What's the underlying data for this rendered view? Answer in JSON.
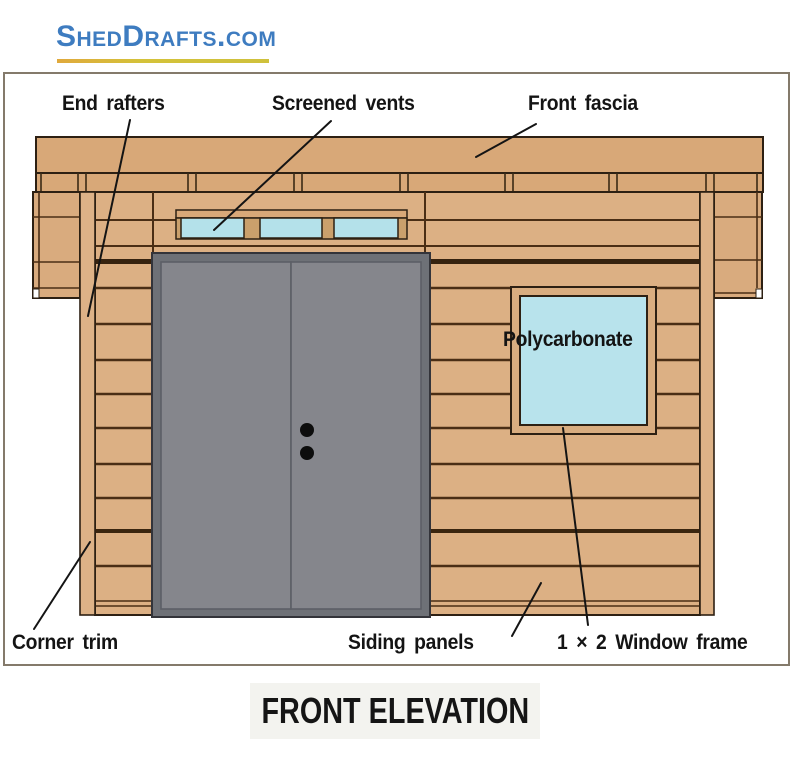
{
  "logo": {
    "text": "ShedDrafts.com",
    "color": "#3e7cc0",
    "underline_color": "#d0c23b"
  },
  "diagram": {
    "title": "FRONT ELEVATION",
    "callouts": {
      "end_rafters": "End rafters",
      "screened_vents": "Screened vents",
      "front_fascia": "Front fascia",
      "polycarbonate": "Polycarbonate",
      "corner_trim": "Corner trim",
      "siding_panels": "Siding panels",
      "window_frame": "1 × 2 Window frame"
    },
    "parts": [
      "End rafters",
      "Screened vents",
      "Front fascia",
      "Polycarbonate",
      "Corner trim",
      "Siding panels",
      "1 × 2 Window frame"
    ],
    "colors": {
      "wood_siding": "#dcb084",
      "wood_fascia": "#d8a878",
      "wood_trim": "#ddb287",
      "board_gap_line": "#4a2e15",
      "outline": "#2d2013",
      "door_leaf_gray": "#85868c",
      "door_frame_gray": "#6e7177",
      "glass_blue": "#b8e3ec",
      "vent_blue": "#b4e1ea",
      "title_background": "#f3f3ef",
      "label_text": "#141414"
    }
  }
}
